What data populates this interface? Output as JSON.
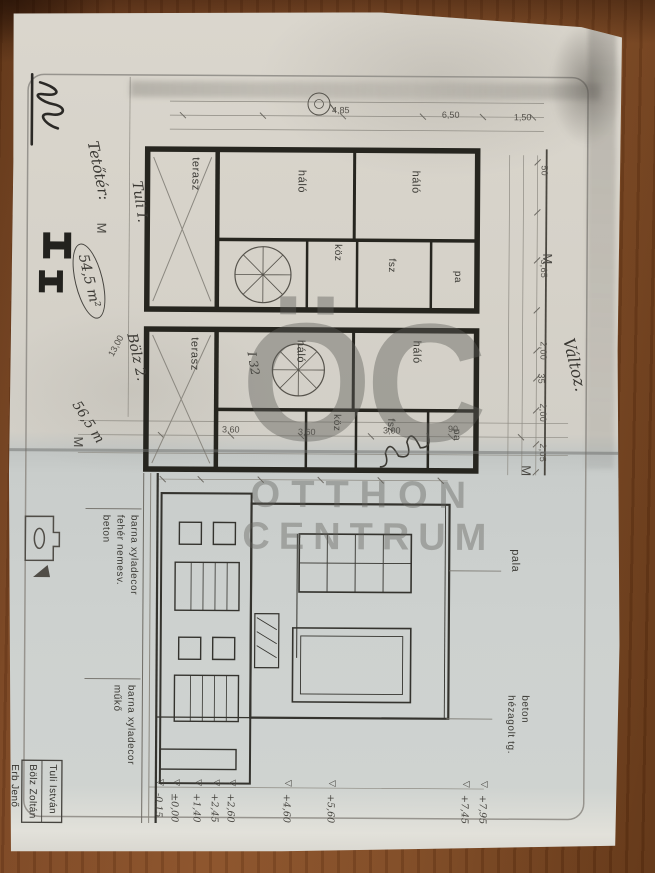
{
  "watermark": {
    "logo": "ÖC",
    "line1": "OTTHON",
    "line2": "CENTRUM"
  },
  "handwriting": {
    "tetoter_label": "Tetőtér:",
    "tetoter_value": "54,5 m²",
    "area_total": "56,5 m",
    "plan_upper_name": "Tuli I.",
    "plan_lower_name": "Bölz 2.",
    "change_note": "Változ.",
    "dim_13": "13,00",
    "stair_note": "I 32"
  },
  "marks": {
    "m1": "M",
    "m2": "M",
    "m3": "M",
    "m4": "M",
    "level_triangle": "▽"
  },
  "plan_upper": {
    "terasz": "terasz",
    "halo_a": "háló",
    "halo_b": "háló",
    "koz": "köz",
    "fsz": "fsz",
    "pa": "pa"
  },
  "plan_lower": {
    "terasz": "terasz",
    "halo_a": "háló",
    "halo_b": "háló",
    "koz": "köz",
    "fsz": "fsz",
    "pa": "pa"
  },
  "dims": {
    "left": [
      "4,85",
      "6,50",
      "1,50"
    ],
    "mid": [
      "3,60",
      "3,60",
      "3,00",
      "90"
    ],
    "top": [
      "50",
      "3,65",
      "2,00",
      "35",
      "2,00",
      "2,05"
    ]
  },
  "elevation": {
    "pala": "pala",
    "beton1": "beton",
    "beton2": "hézagolt tg.",
    "mat_a1": "barna xyladecor",
    "mat_a2": "fehér nemesv.",
    "mat_a3": "beton",
    "mat_b1": "barna xyladecor",
    "mat_b2": "műkő",
    "levels": [
      "+7,95",
      "+7,45",
      "+5,60",
      "+4,60",
      "+2,60",
      "+2,45",
      "+1,40",
      "±0,00",
      "-0,15"
    ]
  },
  "titleblock": {
    "name1": "Tuli István",
    "name2": "Bölz Zoltán",
    "name3": "Erb Jenő"
  }
}
